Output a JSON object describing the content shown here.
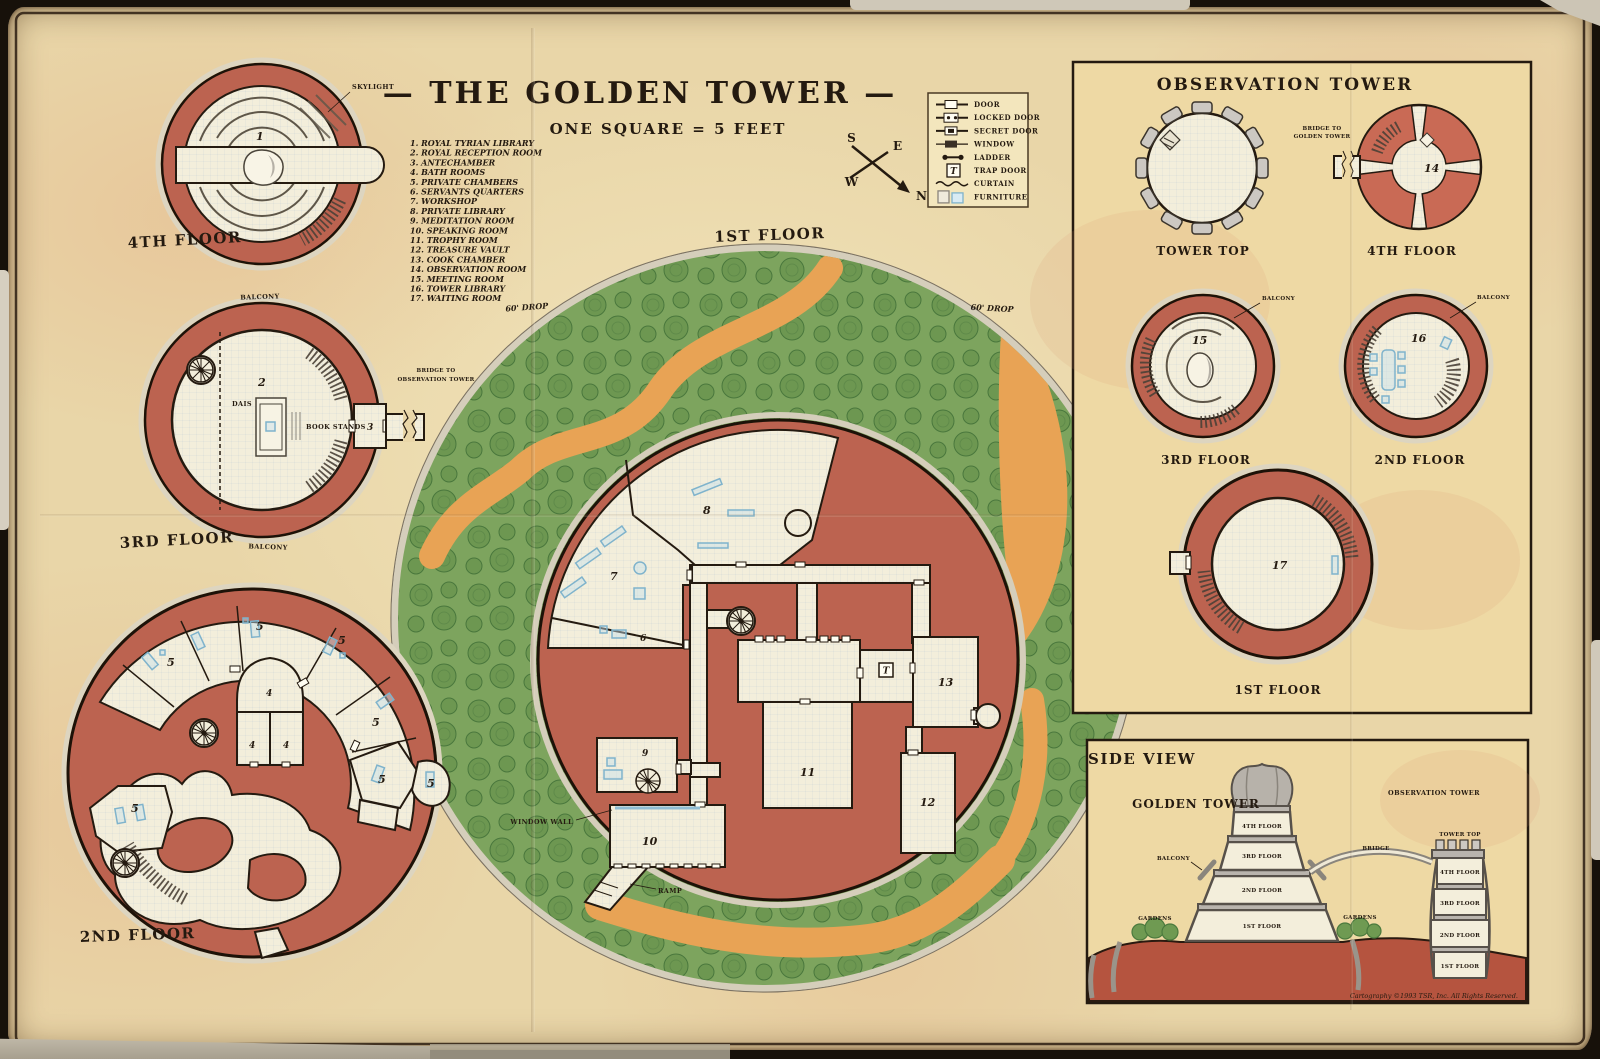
{
  "title": "— THE GOLDEN TOWER —",
  "scale_note": "ONE SQUARE = 5 FEET",
  "compass": {
    "n": "N",
    "e": "E",
    "s": "S",
    "w": "W"
  },
  "room_key": [
    {
      "num": "1",
      "label": "1. ROYAL TYRIAN LIBRARY"
    },
    {
      "num": "2",
      "label": "2. ROYAL RECEPTION ROOM"
    },
    {
      "num": "3",
      "label": "3. ANTECHAMBER"
    },
    {
      "num": "4",
      "label": "4. BATH ROOMS"
    },
    {
      "num": "5",
      "label": "5. PRIVATE CHAMBERS"
    },
    {
      "num": "6",
      "label": "6. SERVANTS QUARTERS"
    },
    {
      "num": "7",
      "label": "7. WORKSHOP"
    },
    {
      "num": "8",
      "label": "8. PRIVATE LIBRARY"
    },
    {
      "num": "9",
      "label": "9. MEDITATION ROOM"
    },
    {
      "num": "10",
      "label": "10. SPEAKING ROOM"
    },
    {
      "num": "11",
      "label": "11. TROPHY ROOM"
    },
    {
      "num": "12",
      "label": "12. TREASURE VAULT"
    },
    {
      "num": "13",
      "label": "13. COOK CHAMBER"
    },
    {
      "num": "14",
      "label": "14. OBSERVATION ROOM"
    },
    {
      "num": "15",
      "label": "15. MEETING ROOM"
    },
    {
      "num": "16",
      "label": "16. TOWER LIBRARY"
    },
    {
      "num": "17",
      "label": "17. WAITING ROOM"
    }
  ],
  "legend": {
    "trap_marker": "T",
    "items": [
      {
        "label": "DOOR"
      },
      {
        "label": "LOCKED DOOR"
      },
      {
        "label": "SECRET DOOR"
      },
      {
        "label": "WINDOW"
      },
      {
        "label": "LADDER"
      },
      {
        "label": "TRAP DOOR"
      },
      {
        "label": "CURTAIN"
      },
      {
        "label": "FURNITURE"
      }
    ]
  },
  "golden_tower": {
    "floor4": {
      "label": "4TH FLOOR",
      "skylight": "SKYLIGHT"
    },
    "floor3": {
      "label": "3RD FLOOR",
      "balcony": "BALCONY",
      "bridge_line1": "BRIDGE TO",
      "bridge_line2": "OBSERVATION TOWER",
      "dais": "DAIS",
      "book_stands": "BOOK STANDS"
    },
    "floor2": {
      "label": "2ND FLOOR"
    },
    "floor1": {
      "label": "1ST FLOOR",
      "drop": "60' DROP",
      "window_wall": "WINDOW WALL",
      "ramp": "RAMP"
    }
  },
  "observation_tower": {
    "title": "OBSERVATION TOWER",
    "tower_top": {
      "label": "TOWER TOP"
    },
    "floor4": {
      "label": "4TH FLOOR",
      "bridge_line1": "BRIDGE TO",
      "bridge_line2": "GOLDEN TOWER"
    },
    "floor3": {
      "label": "3RD FLOOR",
      "balcony": "BALCONY"
    },
    "floor2": {
      "label": "2ND FLOOR",
      "balcony": "BALCONY"
    },
    "floor1": {
      "label": "1ST FLOOR"
    }
  },
  "side_view": {
    "title": "SIDE VIEW",
    "golden_tower_label": "GOLDEN TOWER",
    "observation_tower_label": "OBSERVATION TOWER",
    "gt_floor4": "4TH FLOOR",
    "gt_floor3": "3RD FLOOR",
    "gt_floor2": "2ND FLOOR",
    "gt_floor1": "1ST FLOOR",
    "balcony": "BALCONY",
    "gardens": "GARDENS",
    "bridge": "BRIDGE",
    "ot_top": "TOWER TOP",
    "ot_floor4": "4TH FLOOR",
    "ot_floor3": "3RD FLOOR",
    "ot_floor2": "2ND FLOOR",
    "ot_floor1": "1ST FLOOR",
    "copyright": "Cartography ©1993 TSR, Inc. All Rights Reserved."
  },
  "colors": {
    "parchment": "#e9d6a8",
    "wall_red": "#bc6350",
    "room_cream": "#f3eedb",
    "garden_green": "#7da45e",
    "path_orange": "#e8a355",
    "furniture_blue": "#8fbdd4",
    "ink": "#241a10"
  }
}
